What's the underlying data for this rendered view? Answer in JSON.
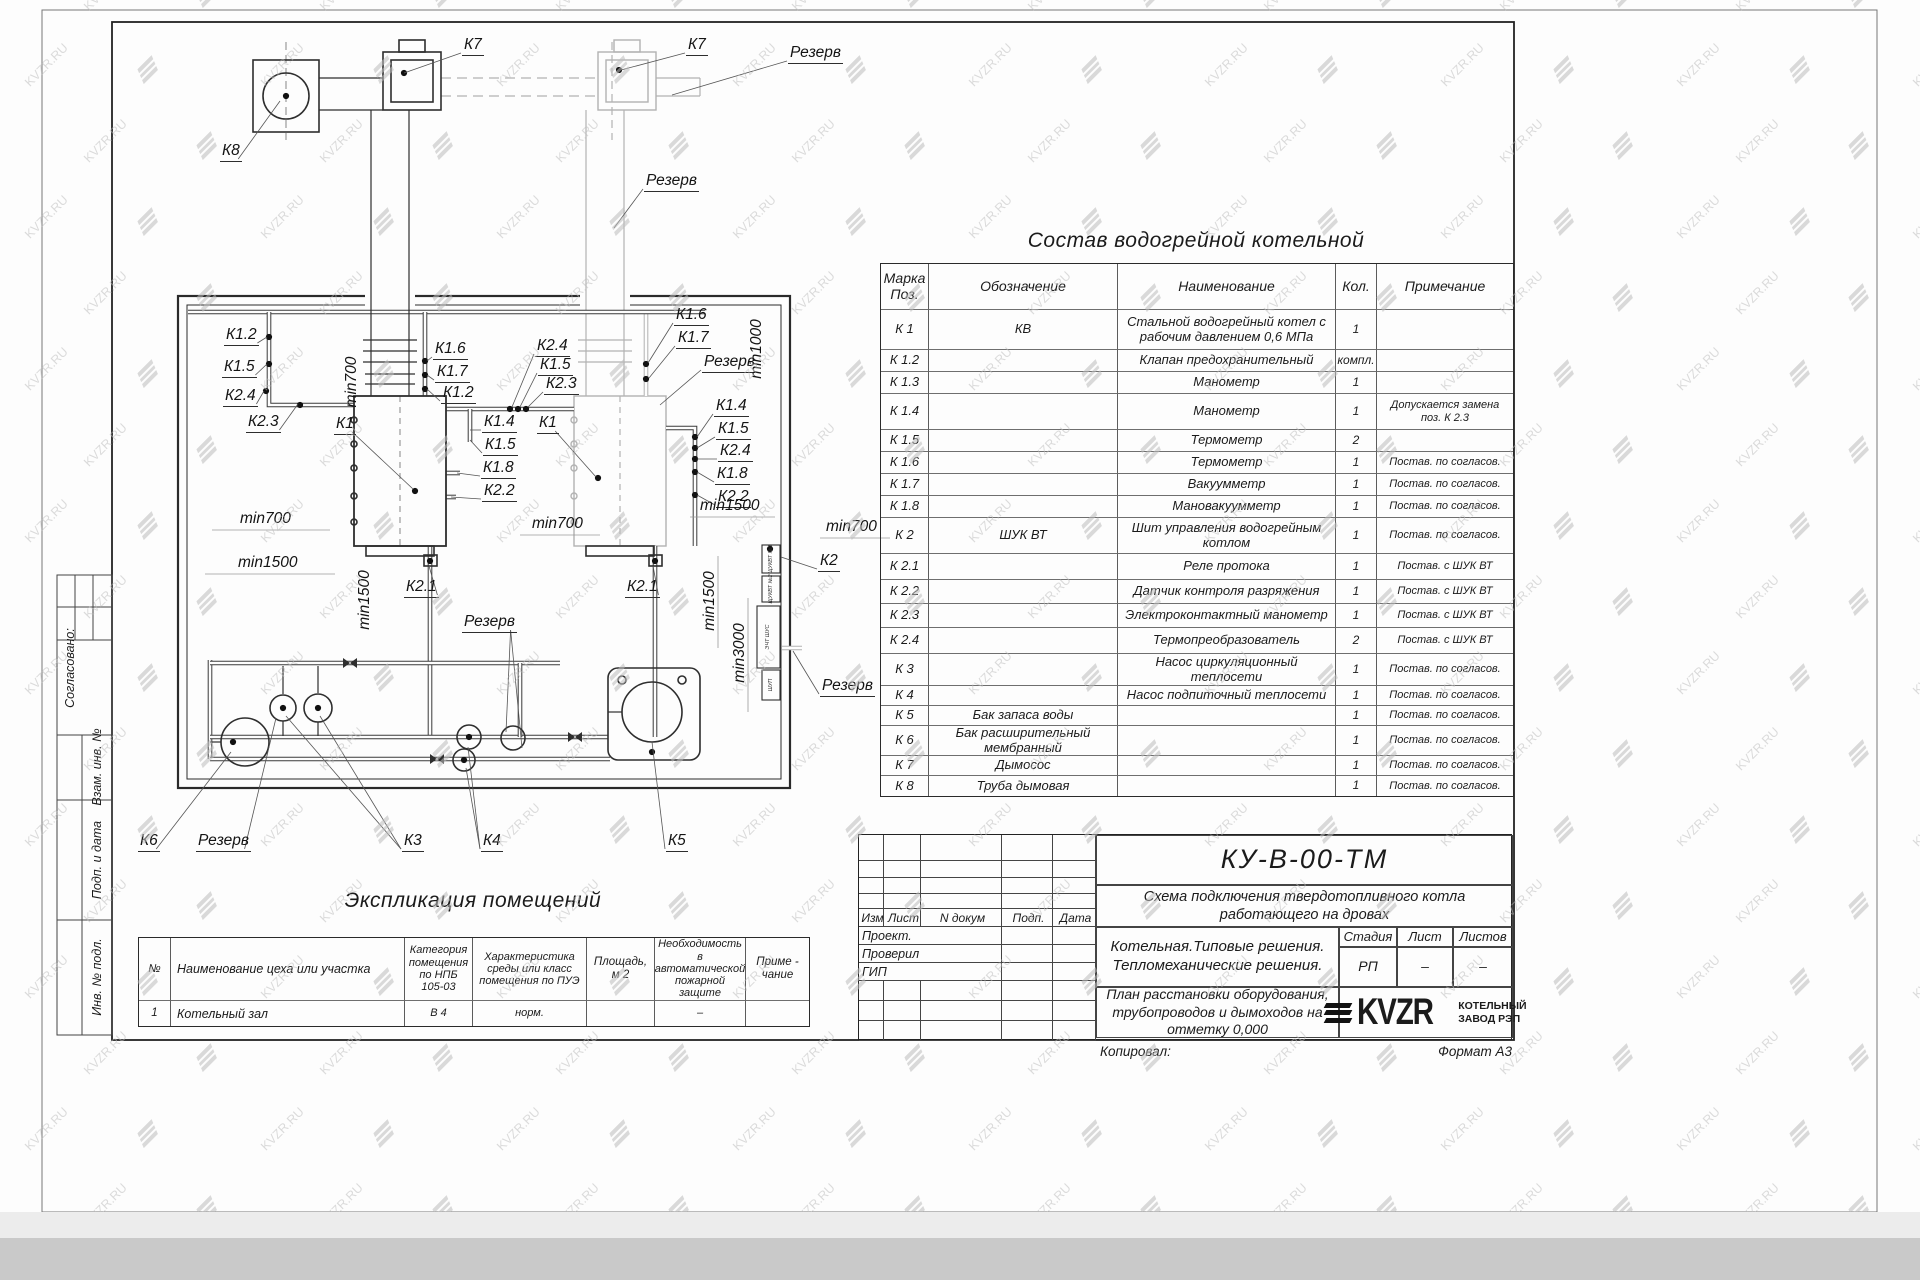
{
  "watermark": {
    "text": "KVZR.RU"
  },
  "sheet": {
    "copied_label": "Копировал:",
    "format_label": "Формат А3"
  },
  "margin_stamps": {
    "agreed": "Согласовано:",
    "boxes": [
      "Взам. инв. №",
      "Подп. и дата",
      "Инв. № подл."
    ]
  },
  "equipment_table": {
    "title": "Состав водогрейной котельной",
    "headers": [
      "Марка Поз.",
      "Обозначение",
      "Наименование",
      "Кол.",
      "Примечание"
    ],
    "rows": [
      [
        "К 1",
        "КВ",
        "Стальной водогрейный котел с рабочим давлением 0,6  МПа",
        "1",
        ""
      ],
      [
        "К 1.2",
        "",
        "Клапан предохранительный",
        "компл.",
        ""
      ],
      [
        "К 1.3",
        "",
        "Манометр",
        "1",
        ""
      ],
      [
        "К 1.4",
        "",
        "Манометр",
        "1",
        "Допускается замена поз. К 2.3"
      ],
      [
        "К 1.5",
        "",
        "Термометр",
        "2",
        ""
      ],
      [
        "К 1.6",
        "",
        "Термометр",
        "1",
        "Постав. по согласов."
      ],
      [
        "К 1.7",
        "",
        "Вакуумметр",
        "1",
        "Постав. по согласов."
      ],
      [
        "К 1.8",
        "",
        "Мановакуумметр",
        "1",
        "Постав. по согласов."
      ],
      [
        "К 2",
        "ШУК ВТ",
        "Шит управления водогрейным котлом",
        "1",
        "Постав. по согласов."
      ],
      [
        "К 2.1",
        "",
        "Реле протока",
        "1",
        "Постав. с ШУК ВТ"
      ],
      [
        "К 2.2",
        "",
        "Датчик контроля разряжения",
        "1",
        "Постав. с ШУК ВТ"
      ],
      [
        "К 2.3",
        "",
        "Электроконтактный манометр",
        "1",
        "Постав. с ШУК ВТ"
      ],
      [
        "К 2.4",
        "",
        "Термопреобразователь",
        "2",
        "Постав. с ШУК ВТ"
      ],
      [
        "К 3",
        "",
        "Насос циркуляционный теплосети",
        "1",
        "Постав. по согласов."
      ],
      [
        "К 4",
        "",
        "Насос подпиточный теплосети",
        "1",
        "Постав. по согласов."
      ],
      [
        "К 5",
        "Бак запаса воды",
        "",
        "1",
        "Постав. по согласов."
      ],
      [
        "К 6",
        "Бак расширительный мембранный",
        "",
        "1",
        "Постав. по согласов."
      ],
      [
        "К 7",
        "Дымосос",
        "",
        "1",
        "Постав. по согласов."
      ],
      [
        "К 8",
        "Труба дымовая",
        "",
        "1",
        "Постав. по согласов."
      ]
    ]
  },
  "rooms_table": {
    "title": "Экспликация помещений",
    "headers": [
      "№",
      "Наименование цеха или участка",
      "Категория помещения по НПБ 105-03",
      "Характеристика среды или класс помещения по ПУЭ",
      "Площадь, м 2",
      "Необходимость в автоматической пожарной защите",
      "Приме - чание"
    ],
    "rows": [
      [
        "1",
        "Котельный зал",
        "В 4",
        "норм.",
        "",
        "–",
        ""
      ]
    ]
  },
  "title_block": {
    "doc_number": "КУ-В-00-ТМ",
    "subtitle": "Схема подключения твердотопливного котла работающего на дровах",
    "rev_headers": [
      "Изм",
      "Лист",
      "N докум",
      "Подп.",
      "Дата"
    ],
    "roles": [
      "Проект.",
      "Проверил",
      "ГИП"
    ],
    "project_lines": "Котельная.Типовые решения.\nТепломеханические решения.",
    "stage_headers": [
      "Стадия",
      "Лист",
      "Листов"
    ],
    "stage_values": [
      "РП",
      "–",
      "–"
    ],
    "plan_title": "План расстановки оборудования, трубопроводов и дымоходов на отметку  0,000",
    "logo_text": "KVZR",
    "logo_caption": "КОТЕЛЬНЫЙ\nЗАВОД РЭП"
  },
  "drawing": {
    "labels": [
      {
        "t": "К7",
        "x": 462,
        "y": 36,
        "u": 1,
        "l": [
          [
            404,
            73
          ]
        ]
      },
      {
        "t": "К7",
        "x": 686,
        "y": 36,
        "u": 1,
        "l": [
          [
            621,
            70
          ]
        ]
      },
      {
        "t": "Резерв",
        "x": 788,
        "y": 44,
        "u": 1,
        "l": [
          [
            672,
            95
          ]
        ]
      },
      {
        "t": "К8",
        "x": 220,
        "y": 142,
        "u": 1,
        "l": [
          [
            280,
            101
          ]
        ]
      },
      {
        "t": "Резерв",
        "x": 644,
        "y": 172,
        "u": 1,
        "l": [
          [
            614,
            228
          ]
        ]
      },
      {
        "t": "К1.2",
        "x": 224,
        "y": 326,
        "u": 1,
        "l": [
          [
            267,
            337
          ]
        ]
      },
      {
        "t": "К1.5",
        "x": 222,
        "y": 358,
        "u": 1,
        "l": [
          [
            267,
            364
          ]
        ]
      },
      {
        "t": "К2.4",
        "x": 223,
        "y": 387,
        "u": 1,
        "l": [
          [
            264,
            391
          ]
        ]
      },
      {
        "t": "К2.3",
        "x": 246,
        "y": 413,
        "u": 1,
        "l": [
          [
            298,
            404
          ]
        ]
      },
      {
        "t": "К1",
        "x": 334,
        "y": 415,
        "u": 1,
        "l": [
          [
            413,
            489
          ]
        ]
      },
      {
        "t": "К1.6",
        "x": 433,
        "y": 340,
        "u": 1,
        "l": [
          [
            427,
            361
          ]
        ]
      },
      {
        "t": "К1.7",
        "x": 435,
        "y": 363,
        "u": 1,
        "l": [
          [
            427,
            375
          ]
        ]
      },
      {
        "t": "К1.2",
        "x": 441,
        "y": 384,
        "u": 1,
        "l": [
          [
            427,
            389
          ]
        ]
      },
      {
        "t": "К2.4",
        "x": 535,
        "y": 337,
        "u": 1,
        "l": [
          [
            512,
            407
          ]
        ]
      },
      {
        "t": "К1.5",
        "x": 538,
        "y": 356,
        "u": 1,
        "l": [
          [
            520,
            407
          ]
        ]
      },
      {
        "t": "К2.3",
        "x": 544,
        "y": 375,
        "u": 1,
        "l": [
          [
            528,
            407
          ]
        ]
      },
      {
        "t": "К1.4",
        "x": 482,
        "y": 413,
        "u": 1,
        "l": [
          [
            470,
            430
          ]
        ]
      },
      {
        "t": "К1",
        "x": 537,
        "y": 414,
        "u": 1,
        "l": [
          [
            596,
            477
          ]
        ]
      },
      {
        "t": "К1.5",
        "x": 483,
        "y": 436,
        "u": 1,
        "l": [
          [
            470,
            440
          ]
        ]
      },
      {
        "t": "К1.8",
        "x": 481,
        "y": 459,
        "u": 1,
        "l": [
          [
            457,
            473
          ]
        ]
      },
      {
        "t": "К2.2",
        "x": 482,
        "y": 482,
        "u": 1,
        "l": [
          [
            451,
            497
          ]
        ]
      },
      {
        "t": "К1.6",
        "x": 674,
        "y": 306,
        "u": 1,
        "l": [
          [
            648,
            363
          ]
        ]
      },
      {
        "t": "К1.7",
        "x": 676,
        "y": 329,
        "u": 1,
        "l": [
          [
            649,
            378
          ]
        ]
      },
      {
        "t": "Резерв",
        "x": 702,
        "y": 353,
        "u": 1,
        "l": [
          [
            660,
            405
          ]
        ]
      },
      {
        "t": "min1000",
        "x": 757,
        "y": 349,
        "r": 1
      },
      {
        "t": "К1.4",
        "x": 714,
        "y": 397,
        "u": 1,
        "l": [
          [
            697,
            437
          ]
        ]
      },
      {
        "t": "К1.5",
        "x": 716,
        "y": 420,
        "u": 1,
        "l": [
          [
            697,
            448
          ]
        ]
      },
      {
        "t": "К2.4",
        "x": 718,
        "y": 442,
        "u": 1,
        "l": [
          [
            697,
            459
          ]
        ]
      },
      {
        "t": "К1.8",
        "x": 715,
        "y": 465,
        "u": 1,
        "l": [
          [
            697,
            472
          ]
        ]
      },
      {
        "t": "К2.2",
        "x": 716,
        "y": 488,
        "u": 1,
        "l": [
          [
            697,
            495
          ]
        ]
      },
      {
        "t": "min700",
        "x": 352,
        "y": 382,
        "r": 1
      },
      {
        "t": "min700",
        "x": 240,
        "y": 510
      },
      {
        "t": "min1500",
        "x": 238,
        "y": 554
      },
      {
        "t": "min700",
        "x": 532,
        "y": 515
      },
      {
        "t": "min1500",
        "x": 700,
        "y": 497
      },
      {
        "t": "min700",
        "x": 826,
        "y": 518
      },
      {
        "t": "К2.1",
        "x": 404,
        "y": 578,
        "u": 1,
        "l": [
          [
            429,
            566
          ]
        ]
      },
      {
        "t": "К2.1",
        "x": 625,
        "y": 578,
        "u": 1,
        "l": [
          [
            653,
            566
          ]
        ]
      },
      {
        "t": "min1500",
        "x": 365,
        "y": 600,
        "r": 1
      },
      {
        "t": "min1500",
        "x": 710,
        "y": 601,
        "r": 1
      },
      {
        "t": "Резерв",
        "x": 462,
        "y": 613,
        "u": 1,
        "l": [
          [
            506,
            732
          ],
          [
            522,
            748
          ]
        ]
      },
      {
        "t": "min3000",
        "x": 740,
        "y": 653,
        "r": 1
      },
      {
        "t": "К2",
        "x": 818,
        "y": 552,
        "u": 1,
        "l": [
          [
            781,
            557
          ]
        ]
      },
      {
        "t": "Резерв",
        "x": 820,
        "y": 677,
        "u": 1,
        "l": [
          [
            793,
            651
          ]
        ]
      },
      {
        "t": "К6",
        "x": 138,
        "y": 832,
        "u": 1,
        "l": [
          [
            231,
            752
          ]
        ]
      },
      {
        "t": "Резерв",
        "x": 196,
        "y": 832,
        "u": 1,
        "l": [
          [
            276,
            718
          ]
        ]
      },
      {
        "t": "К3",
        "x": 402,
        "y": 832,
        "u": 1,
        "l": [
          [
            286,
            716
          ],
          [
            320,
            716
          ]
        ]
      },
      {
        "t": "К4",
        "x": 481,
        "y": 832,
        "u": 1,
        "l": [
          [
            468,
            747
          ],
          [
            466,
            768
          ]
        ]
      },
      {
        "t": "К5",
        "x": 666,
        "y": 832,
        "u": 1,
        "l": [
          [
            652,
            742
          ]
        ]
      }
    ],
    "cabinets": [
      {
        "t": "ЩУКВТ №1",
        "x": 771,
        "y": 559
      },
      {
        "t": "ЩУКВТ №2",
        "x": 771,
        "y": 589
      },
      {
        "t": "ЭЧТ ШУС",
        "x": 768,
        "y": 637
      },
      {
        "t": "ШУП",
        "x": 771,
        "y": 685
      }
    ]
  }
}
